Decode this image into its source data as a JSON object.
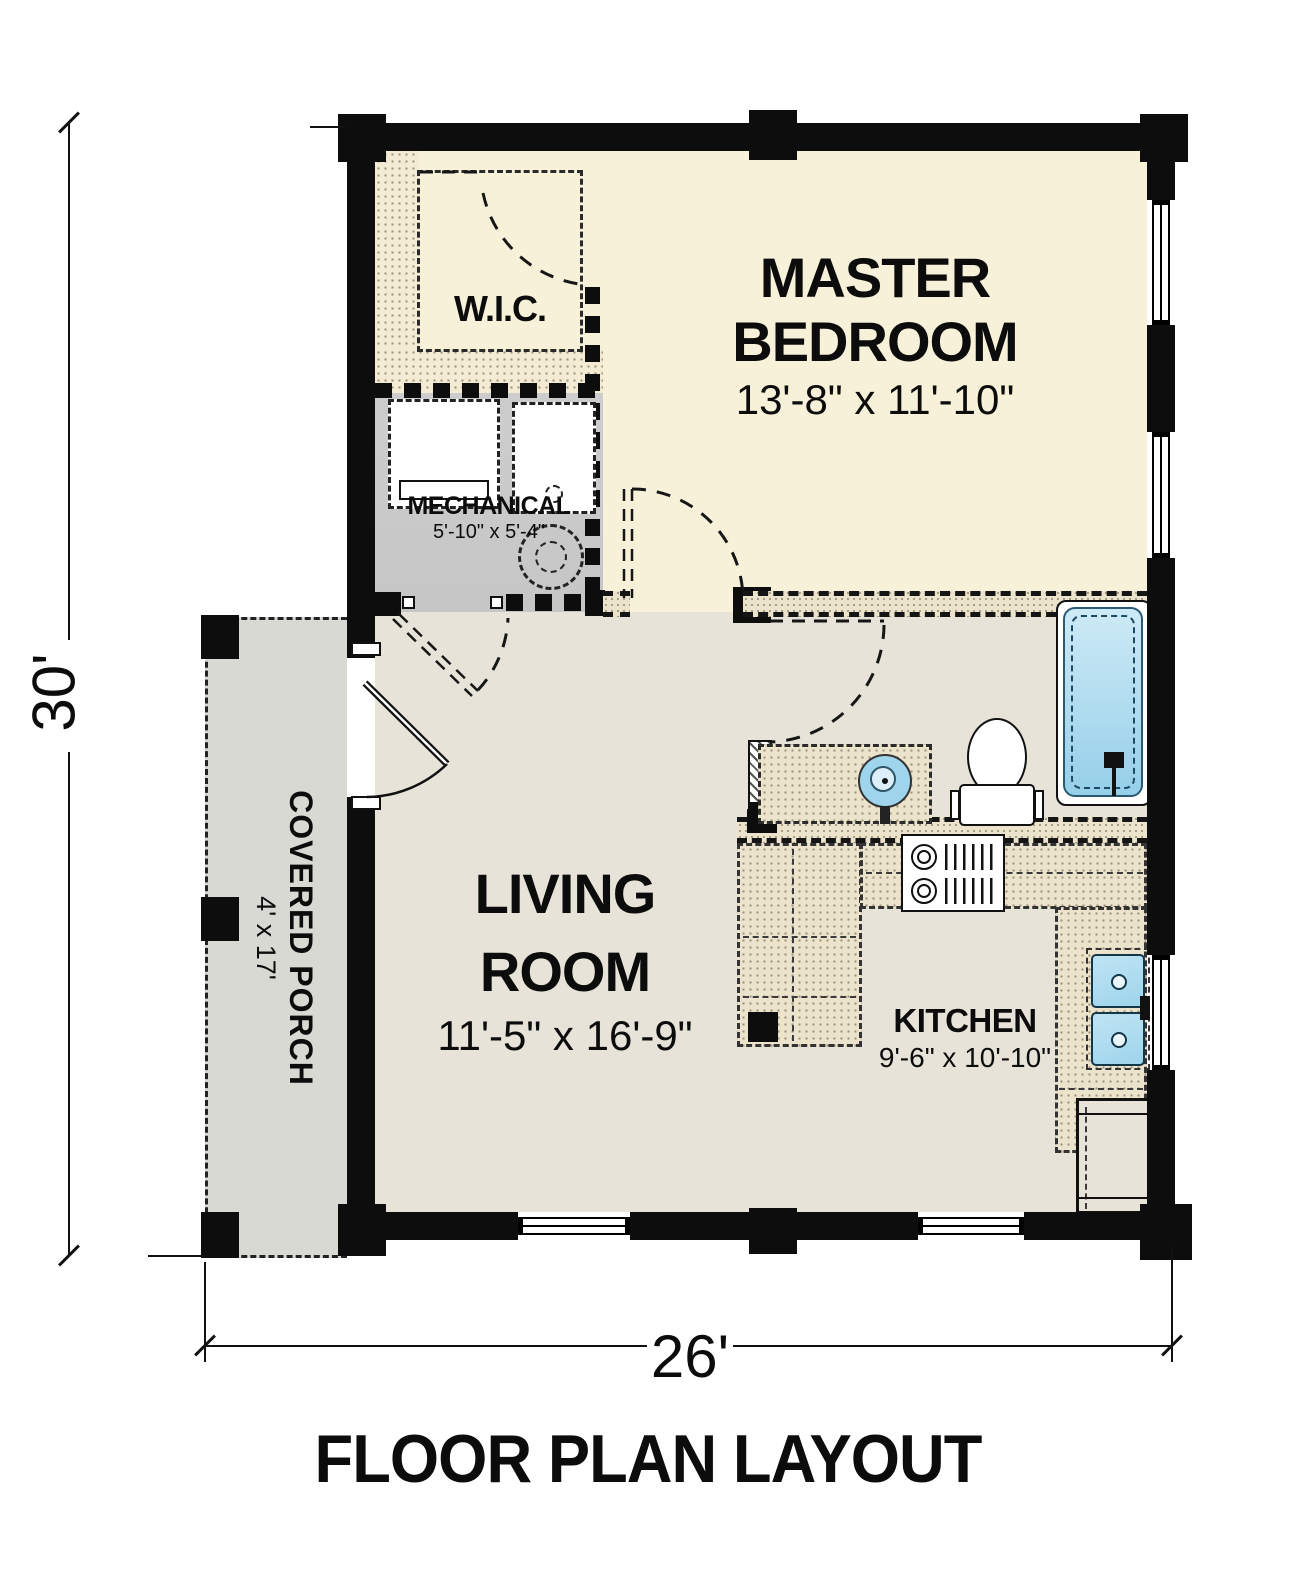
{
  "title": "FLOOR PLAN LAYOUT",
  "dimensions": {
    "overall_height": "30'",
    "overall_width": "26'"
  },
  "rooms": {
    "master_bedroom": {
      "line1": "MASTER",
      "line2": "BEDROOM",
      "size": "13'-8\" x 11'-10\""
    },
    "wic": {
      "name": "W.I.C."
    },
    "mechanical": {
      "name": "MECHANICAL",
      "size": "5'-10\" x 5'-4\""
    },
    "living_room": {
      "line1": "LIVING",
      "line2": "ROOM",
      "size": "11'-5\" x 16'-9\""
    },
    "kitchen": {
      "name": "KITCHEN",
      "size": "9'-6\" x 10'-10\""
    },
    "covered_porch": {
      "name": "COVERED PORCH",
      "size": "4' x 17'"
    }
  },
  "fixtures": [
    "bathtub",
    "toilet",
    "bathroom-sink",
    "vanity",
    "kitchen-sink",
    "stove",
    "refrigerator",
    "washer",
    "dryer",
    "water-heater"
  ],
  "colors": {
    "wall": "#0d0d0d",
    "bedroom_fill": "#f8f1d9",
    "living_fill": "#e7e3d8",
    "mechanical_fill": "#c6c6c6",
    "porch_fill": "#d9d9d4",
    "counter_fill": "#ece3cd",
    "hatch_dot": "#9a9178",
    "fixture_blue": "#9ed4ec",
    "fixture_blue_light": "#cdeaf6"
  }
}
